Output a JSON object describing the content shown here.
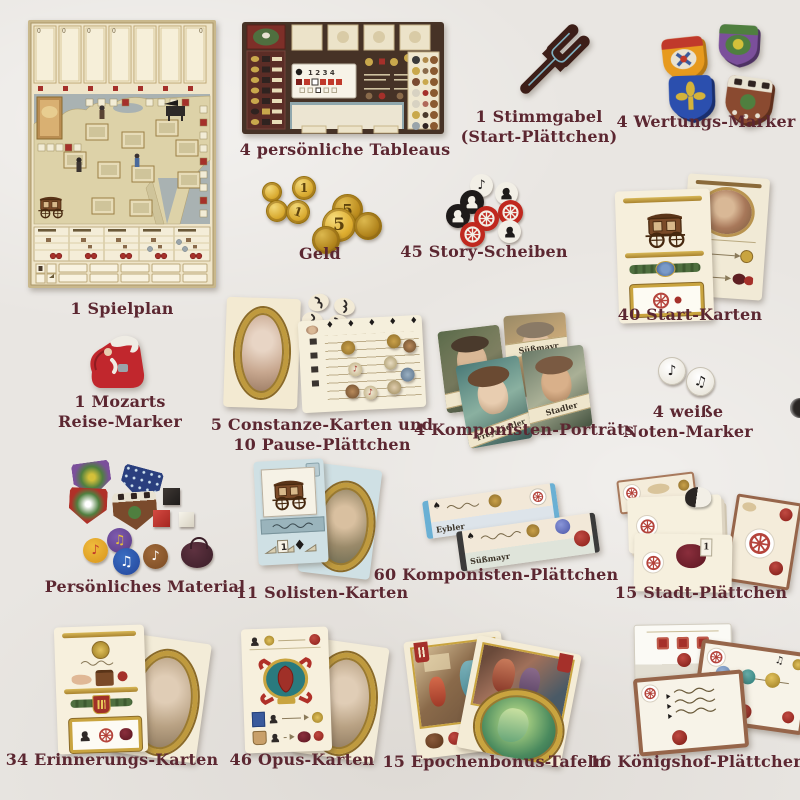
{
  "page": {
    "background": "#e9e6e2",
    "label_color": "#5c2731"
  },
  "icons": {
    "note": "♪",
    "beamed_note": "♫",
    "diamond": "♦",
    "spade": "♠"
  },
  "board": {
    "slot_value": "0"
  },
  "misc": {
    "one": "1"
  },
  "components": {
    "spielplan": {
      "label": "1 Spielplan"
    },
    "tableaus": {
      "label": "4 persönliche Tableaus",
      "track_numbers": "1 2 3 4"
    },
    "stimmgabel": {
      "lines": [
        "1 Stimmgabel",
        "(Start-Plättchen)"
      ]
    },
    "wertungsmarker": {
      "label": "4 Wertungs-Marker"
    },
    "geld": {
      "label": "Geld",
      "coin_values": {
        "small": "1",
        "large": "5"
      }
    },
    "storyscheiben": {
      "label": "45 Story-Scheiben"
    },
    "startkarten": {
      "label": "40 Start-Karten"
    },
    "reisemarker": {
      "lines": [
        "1 Mozarts",
        "Reise-Marker"
      ]
    },
    "constanze": {
      "lines": [
        "5 Constanze-Karten und",
        "10 Pause-Plättchen"
      ]
    },
    "portraets": {
      "label": "4 Komponisten-Porträts",
      "names": [
        "Eybler",
        "Süßmayr",
        "Freystädtler",
        "Stadler"
      ]
    },
    "notenmarker": {
      "lines": [
        "4 weiße",
        "Noten-Marker"
      ]
    },
    "material": {
      "label": "Persönliches Material"
    },
    "solisten": {
      "label": "11 Solisten-Karten"
    },
    "komponisten_plaettchen": {
      "label": "60 Komponisten-Plättchen",
      "names": [
        "Eybler",
        "Süßmayr"
      ]
    },
    "stadt_plaettchen": {
      "label": "15 Stadt-Plättchen"
    },
    "erinnerungs_karten": {
      "label": "34 Erinnerungs-Karten"
    },
    "opus_karten": {
      "label": "46 Opus-Karten"
    },
    "epochenbonus": {
      "label": "15 Epochenbonus-Tafeln"
    },
    "koenigshof": {
      "label": "16 Königshof-Plättchen"
    }
  }
}
